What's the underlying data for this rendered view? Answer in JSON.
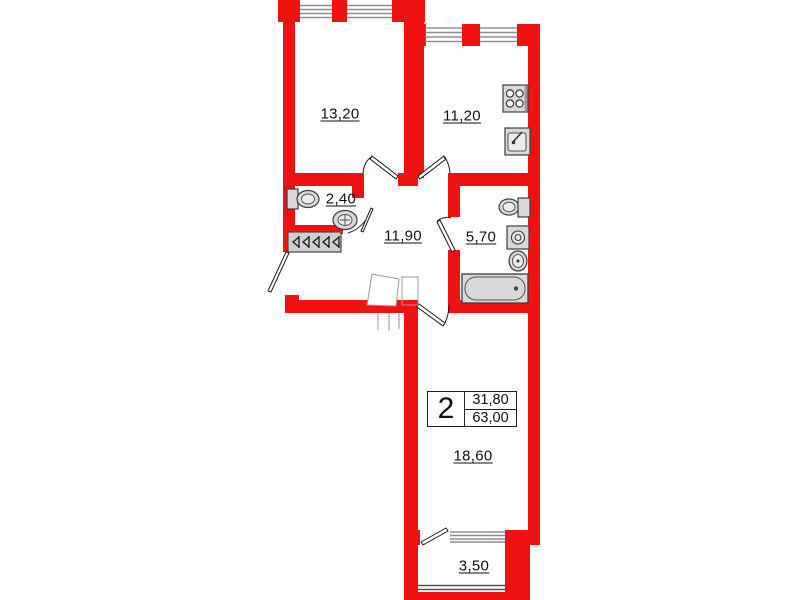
{
  "plan": {
    "type": "apartment-floor-plan",
    "unit_badge": {
      "rooms_count": "2",
      "living_area": "31,80",
      "total_area": "63,00"
    },
    "rooms": [
      {
        "key": "living-room",
        "label": "13,20"
      },
      {
        "key": "kitchen",
        "label": "11,20"
      },
      {
        "key": "wc",
        "label": "2,40"
      },
      {
        "key": "hallway",
        "label": "11,90"
      },
      {
        "key": "bathroom",
        "label": "5,70"
      },
      {
        "key": "bedroom",
        "label": "18,60"
      },
      {
        "key": "balcony",
        "label": "3,50"
      }
    ],
    "colors": {
      "wall": "#f01111",
      "fixture_fill": "#d9d9d9",
      "fixture_outline": "#3d3d3d",
      "window_line": "#8f8f8f"
    },
    "icons": [
      "stove-icon",
      "kitchen-sink-icon",
      "wc-toilet-icon",
      "wc-basin-icon",
      "wardrobe-icon",
      "bath-toilet-icon",
      "washing-machine-icon",
      "bath-basin-icon",
      "bathtub-icon"
    ]
  }
}
